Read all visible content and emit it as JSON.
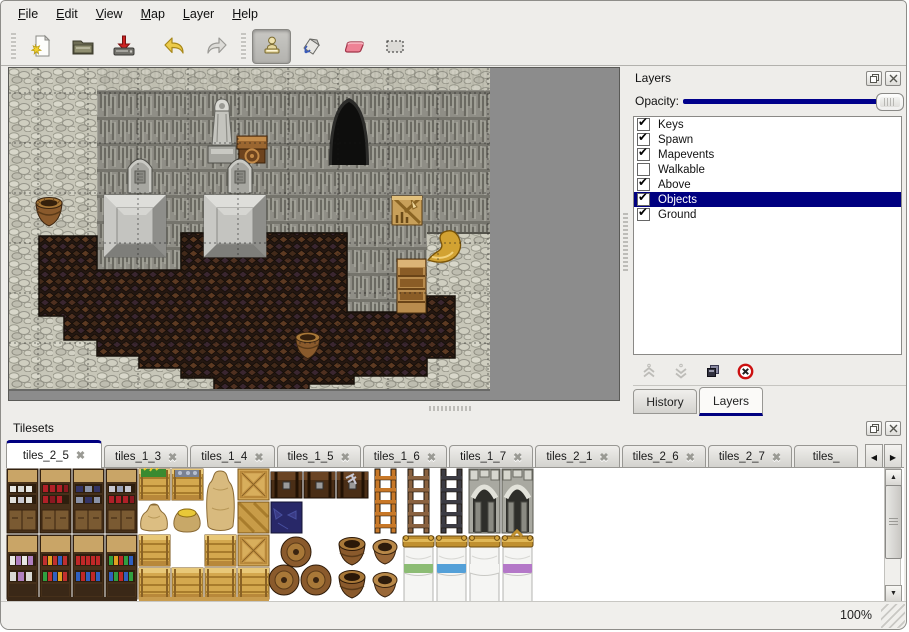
{
  "menubar": {
    "items": [
      {
        "label": "File"
      },
      {
        "label": "Edit"
      },
      {
        "label": "View"
      },
      {
        "label": "Map"
      },
      {
        "label": "Layer"
      },
      {
        "label": "Help"
      }
    ]
  },
  "toolbar": {
    "buttons": [
      {
        "name": "new-file",
        "icon": "new-page-star-icon",
        "active": false
      },
      {
        "name": "open",
        "icon": "open-folder-icon",
        "active": false
      },
      {
        "name": "save",
        "icon": "save-drive-red-arrow-icon",
        "active": false
      },
      {
        "name": "undo",
        "icon": "undo-yellow-arrow-icon",
        "active": false
      },
      {
        "name": "redo",
        "icon": "redo-gray-arrow-icon",
        "active": false
      },
      {
        "name": "stamp-tool",
        "icon": "stamp-icon",
        "active": true
      },
      {
        "name": "fill-tool",
        "icon": "paint-bucket-icon",
        "active": false
      },
      {
        "name": "eraser-tool",
        "icon": "eraser-icon",
        "active": false
      },
      {
        "name": "select-tool",
        "icon": "selection-rectangle-icon",
        "active": false
      }
    ]
  },
  "layers_panel": {
    "title": "Layers",
    "titlebar_icons": [
      "float-panel-icon",
      "close-panel-icon"
    ],
    "opacity_label": "Opacity:",
    "layers": [
      {
        "name": "Keys",
        "checked": true,
        "selected": false
      },
      {
        "name": "Spawn",
        "checked": true,
        "selected": false
      },
      {
        "name": "Mapevents",
        "checked": true,
        "selected": false
      },
      {
        "name": "Walkable",
        "checked": false,
        "selected": false
      },
      {
        "name": "Above",
        "checked": true,
        "selected": false
      },
      {
        "name": "Objects",
        "checked": true,
        "selected": true
      },
      {
        "name": "Ground",
        "checked": true,
        "selected": false
      }
    ],
    "action_icons": [
      "raise-layer-icon",
      "lower-layer-icon",
      "duplicate-layer-icon",
      "delete-layer-icon"
    ],
    "tabs": [
      {
        "label": "History",
        "active": false
      },
      {
        "label": "Layers",
        "active": true
      }
    ]
  },
  "tilesets_panel": {
    "title": "Tilesets",
    "titlebar_icons": [
      "float-panel-icon",
      "close-panel-icon"
    ],
    "tabs": [
      {
        "label": "tiles_2_5",
        "active": true
      },
      {
        "label": "tiles_1_3",
        "active": false
      },
      {
        "label": "tiles_1_4",
        "active": false
      },
      {
        "label": "tiles_1_5",
        "active": false
      },
      {
        "label": "tiles_1_6",
        "active": false
      },
      {
        "label": "tiles_1_7",
        "active": false
      },
      {
        "label": "tiles_2_1",
        "active": false
      },
      {
        "label": "tiles_2_6",
        "active": false
      },
      {
        "label": "tiles_2_7",
        "active": false
      },
      {
        "label": "tiles_",
        "active": false
      }
    ],
    "close_glyph": "✖",
    "scroll_left_glyph": "◀",
    "scroll_right_glyph": "▶"
  },
  "statusbar": {
    "zoom_level": "100%"
  },
  "colors": {
    "selection_navy": "#000080",
    "slider_fill": "#00008b",
    "delete_red": "#cc1111",
    "undo_yellow": "#e2bc3c",
    "eraser_pink": "#e87a8a",
    "panel_bg": "#eeedea",
    "map_outside_gray": "#8c8c8c"
  }
}
